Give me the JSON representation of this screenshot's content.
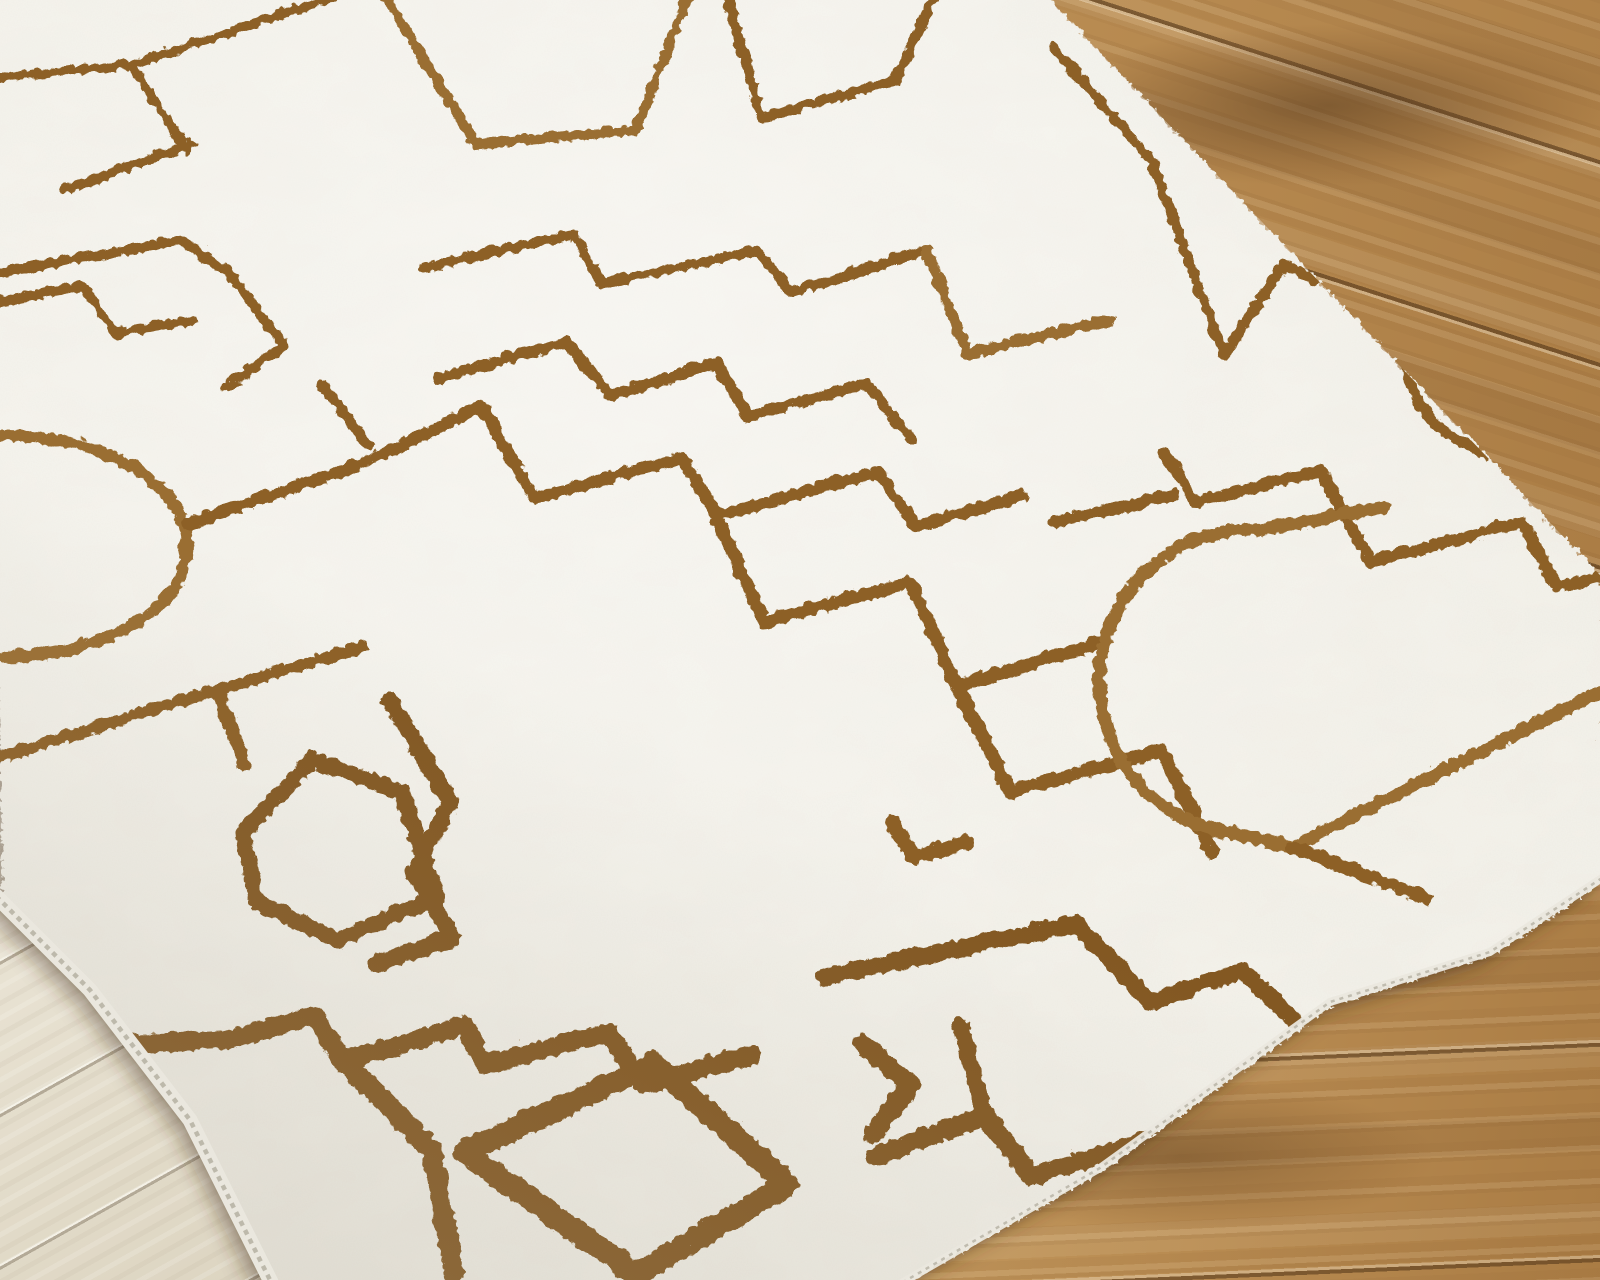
{
  "scene": {
    "type": "product-photo",
    "subject": "Plush cream/ivory area rug with an abstract rust-brown maze line pattern (rectangles, L-shapes, T-bars and semicircle arcs), laid at a diagonal across an oak wood plank floor",
    "width": 1600,
    "height": 1280,
    "visible_text": ""
  },
  "palette": {
    "rug_cream": "#f1efe7",
    "rug_cream_deep": "#ddd9cc",
    "line_brown": "#8d6127",
    "line_brown_light": "#9a6e31",
    "line_brown_dark": "#835922",
    "binding_light": "#eae7de",
    "binding_shadow": "#b5b0a2",
    "oak_light": "#cda76d",
    "oak_mid": "#b98c52",
    "oak_dark": "#aa7c44",
    "pale_wood_light": "#f0ebdf",
    "pale_wood_mid": "#e2dbc9",
    "pale_wood_dark": "#d7ceb9",
    "shadow": "rgba(68,50,30,0.38)"
  },
  "floor": {
    "patches": [
      {
        "id": "tr",
        "area": "top-right",
        "tone": "warm oak planks",
        "seam_angle_deg": 17.8
      },
      {
        "id": "br",
        "area": "bottom-right",
        "tone": "warm oak planks",
        "seam_angle_deg": 177.5
      },
      {
        "id": "bl",
        "area": "bottom-left",
        "tone": "pale washed planks",
        "seam_angle_deg": 150.7
      }
    ]
  },
  "rug": {
    "outline": "M-20,-20 L1040,-10 L1600,575 L1600,880 L1490,952 L1330,1002 L1100,1168 L895,1285 L272,1285 L190,1120 L90,990 L0,900 Z",
    "binding_left": "M-4,896 L90,990 L190,1120 L274,1288",
    "binding_right": "M1602,878 L1490,952 L1330,1002 L1100,1168 L893,1288",
    "pattern": [
      {
        "w": 9,
        "d": "M-10,76 L130,63 L334,-6"
      },
      {
        "w": 9,
        "d": "M130,63 L186,150"
      },
      {
        "w": 10,
        "d": "M62,188 L190,142"
      },
      {
        "w": 10,
        "d": "M-8,272 L178,238 L228,272 L282,344 L225,385"
      },
      {
        "w": 10,
        "d": "M-8,300 L80,284 L115,332 L190,318"
      },
      {
        "w": 10,
        "d": "M380,-10 L474,142 L634,128 L688,-10",
        "c": "line_brown_light"
      },
      {
        "w": 10,
        "d": "M724,-10 L760,116 L894,78 L934,-10"
      },
      {
        "w": 10,
        "d": "M420,266 L573,232 L600,282 L755,248 L790,290 L924,248"
      },
      {
        "w": 11,
        "d": "M924,248 L966,352 L1108,318",
        "c": "line_brown_light"
      },
      {
        "w": 10,
        "d": "M1052,45 L1150,160 L1222,352"
      },
      {
        "w": 11,
        "d": "M438,376 L565,340 L608,394 L714,361 L746,414 L864,381 L910,437"
      },
      {
        "w": 11,
        "d": "M320,382 L366,444"
      },
      {
        "w": 12,
        "d": "M0,433 A185,111 0 0 1 0,655",
        "c": "line_brown_light"
      },
      {
        "w": 12,
        "d": "M186,522 L360,462 L480,404 L532,496 L680,456 L714,514 L876,470 L914,524 L1020,494"
      },
      {
        "w": 13,
        "d": "M714,514 L762,620 L908,580 L955,684 L1100,640"
      },
      {
        "w": 12,
        "d": "M-8,757 L215,688 L360,645"
      },
      {
        "w": 13,
        "d": "M215,688 L242,762"
      },
      {
        "w": 16,
        "d": "M240,830 L310,758 L400,790 L435,895 L335,938 L255,900 Z",
        "c": "line_brown_dark"
      },
      {
        "w": 14,
        "d": "M955,684 L1008,790 L1160,748 L1210,850"
      },
      {
        "w": 11,
        "d": "M1222,352 L1282,262 L1312,278 L1345,232 L1392,250 L1430,290 A95,95 0 0 0 1452,436 L1560,486"
      },
      {
        "w": 12,
        "d": "M1050,520 L1170,494"
      },
      {
        "w": 12,
        "d": "M1163,452 L1194,500 L1318,468 L1368,560 L1520,520 L1555,585 L1610,572"
      },
      {
        "w": 13,
        "d": "M1382,505 L1258,528 A150,152 0 0 0 1215,828 L1290,845 L1610,683",
        "c": "line_brown_light"
      },
      {
        "w": 13,
        "d": "M1290,845 L1424,896"
      },
      {
        "w": 17,
        "d": "M388,698 L448,800 L412,870 L450,936 L374,962",
        "c": "line_brown_dark"
      },
      {
        "w": 19,
        "d": "M125,1042 L230,1037 L313,1013 L340,1060 L463,1023 L483,1063 L607,1030 L640,1083 L750,1053",
        "c": "line_brown_dark"
      },
      {
        "w": 21,
        "d": "M345,1062 L430,1148 L452,1270",
        "c": "line_brown_dark"
      },
      {
        "w": 23,
        "d": "M652,1062 L786,1182 L634,1272 L462,1150 Z",
        "c": "line_brown_dark"
      },
      {
        "w": 20,
        "d": "M860,1042 L908,1082 L872,1132",
        "c": "line_brown_dark"
      },
      {
        "w": 17,
        "d": "M820,975 L1075,922 L1148,1000 L1240,968 L1302,1028",
        "c": "line_brown_dark"
      },
      {
        "w": 19,
        "d": "M873,1155 L982,1113 L1030,1175 L1146,1138",
        "c": "line_brown_dark"
      },
      {
        "w": 17,
        "d": "M958,1022 L982,1113",
        "c": "line_brown_dark"
      },
      {
        "w": 15,
        "d": "M890,820 L912,855 L965,840"
      }
    ]
  }
}
